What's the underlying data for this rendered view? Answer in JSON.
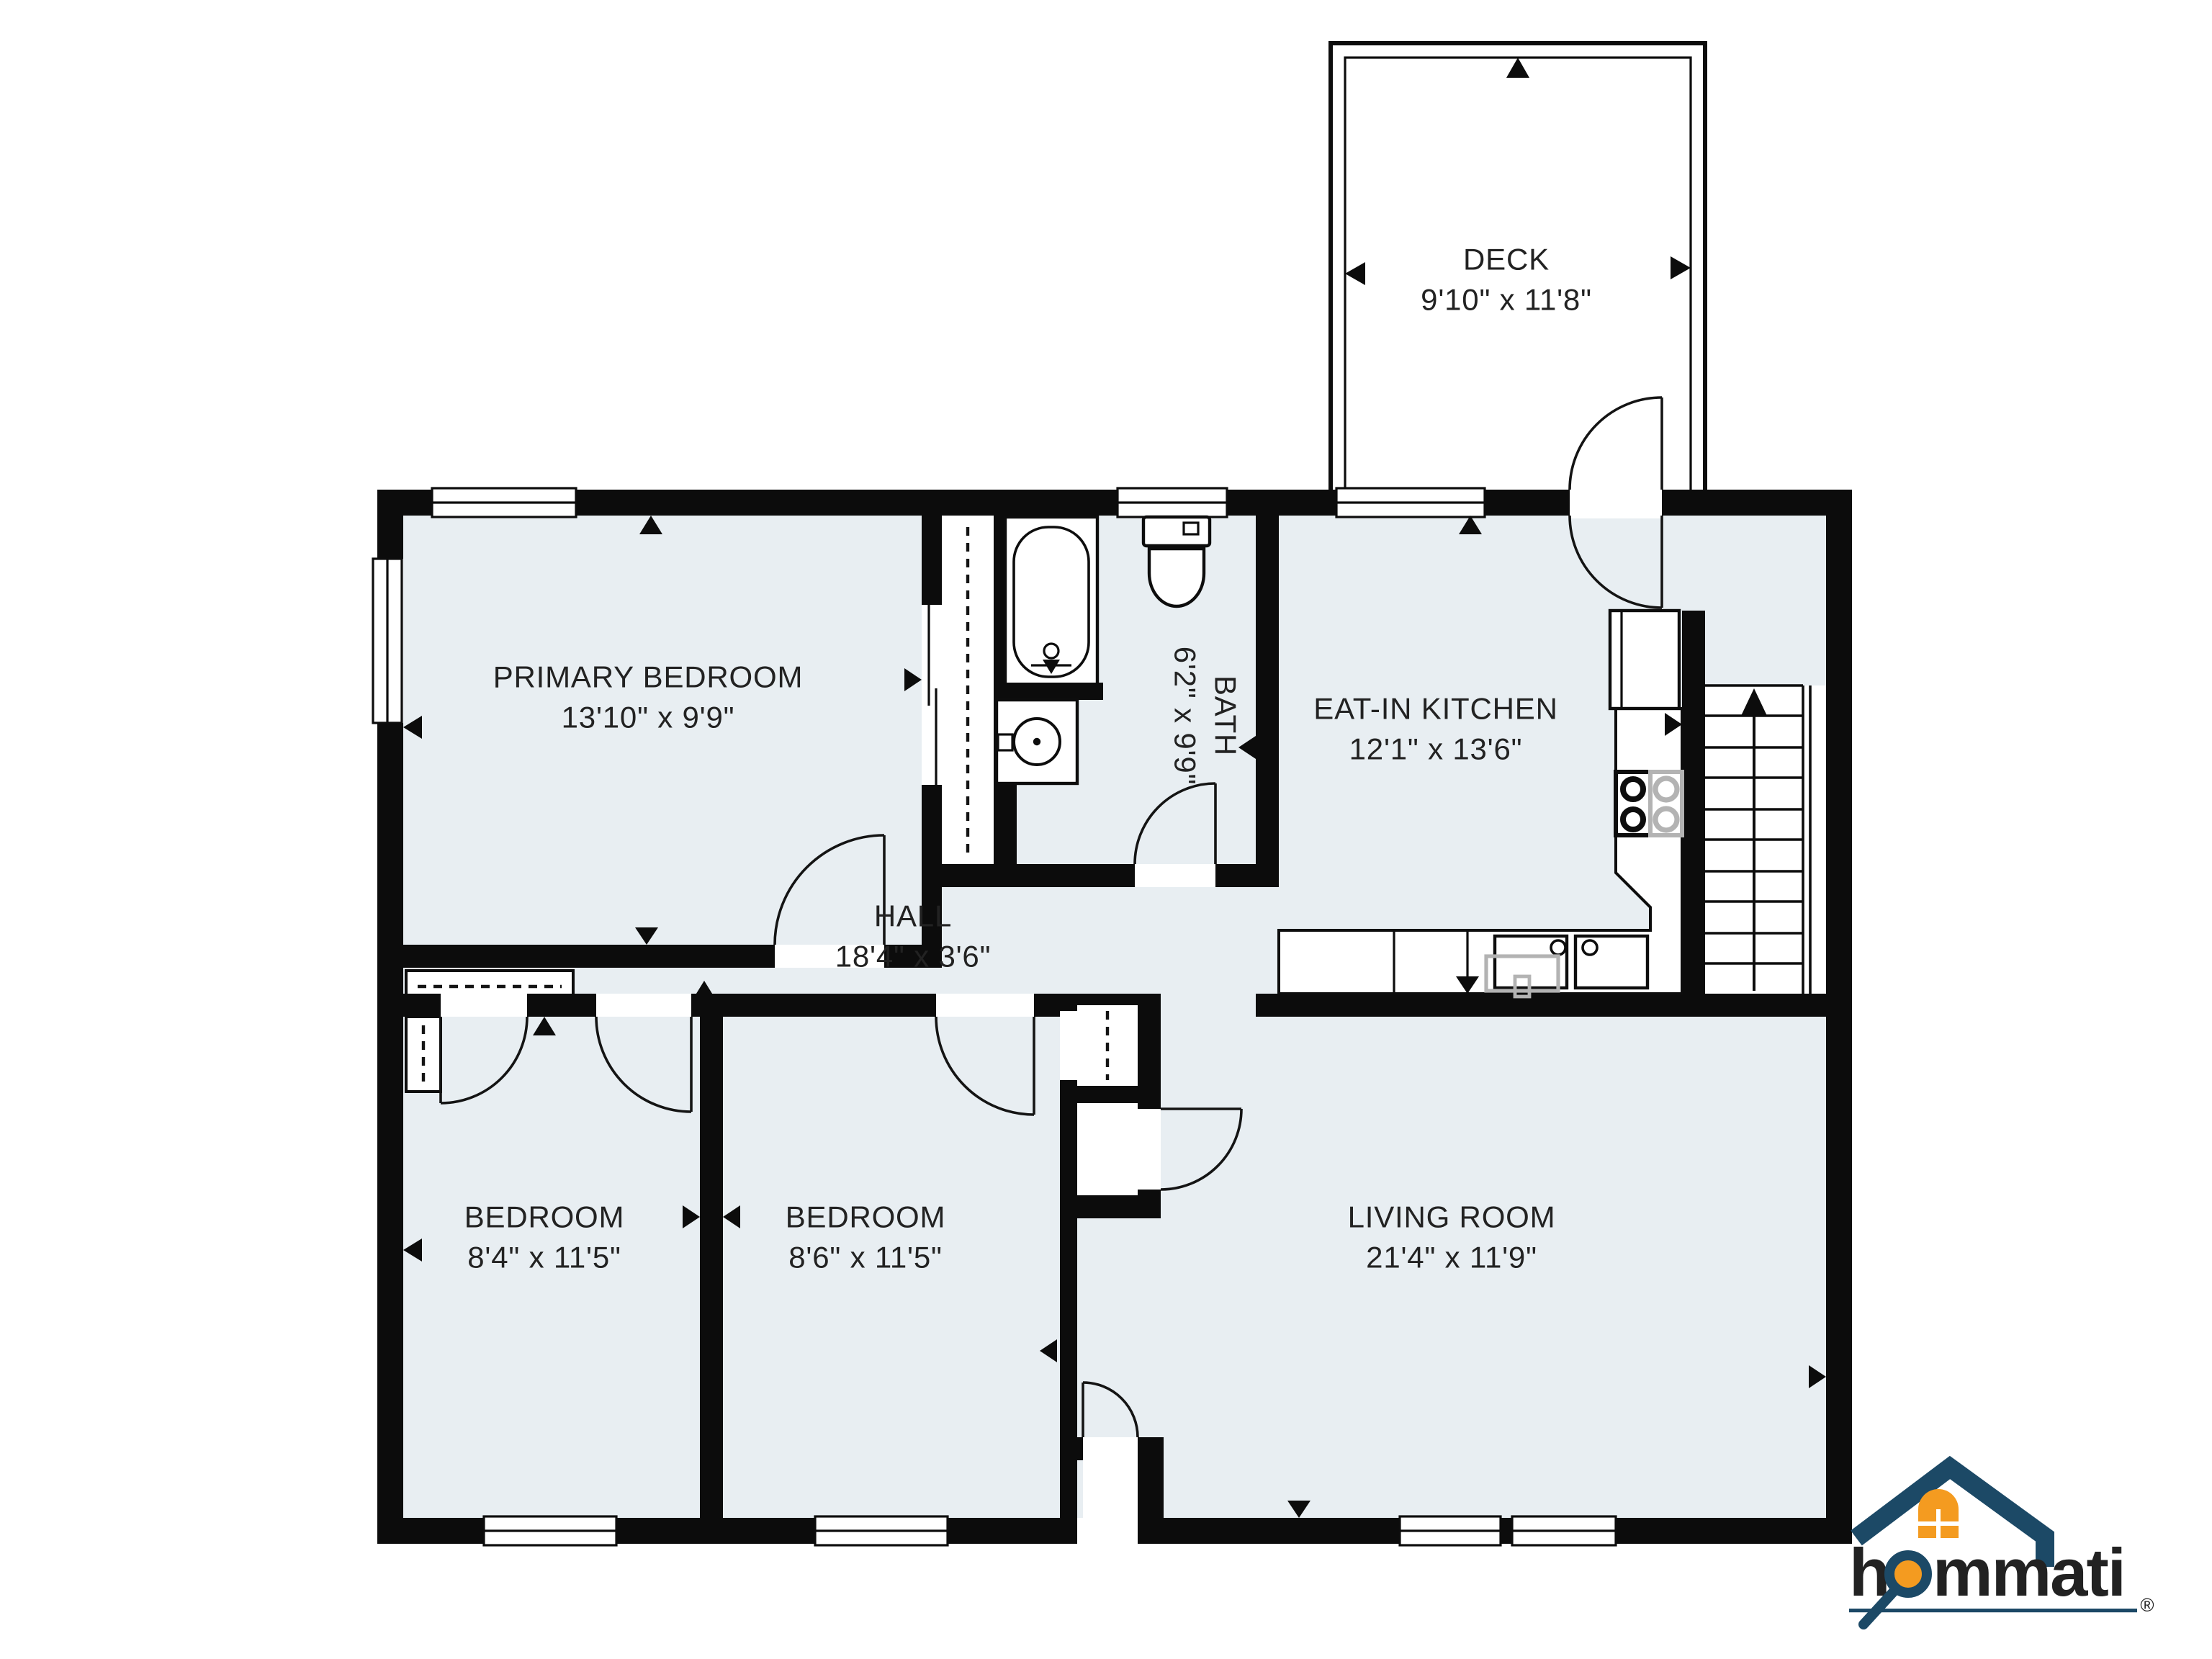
{
  "colors": {
    "floor": "#e8eef2",
    "wall": "#0c0c0c",
    "brand_navy": "#1c4966",
    "brand_orange": "#f49b20"
  },
  "rooms": [
    {
      "id": "deck",
      "name": "DECK",
      "dims": "9'10\" x 11'8\""
    },
    {
      "id": "primary-bedroom",
      "name": "PRIMARY BEDROOM",
      "dims": "13'10\" x 9'9\""
    },
    {
      "id": "bath",
      "name": "BATH",
      "dims": "6'2\" x 9'9\""
    },
    {
      "id": "eat-in-kitchen",
      "name": "EAT-IN KITCHEN",
      "dims": "12'1\" x 13'6\""
    },
    {
      "id": "hall",
      "name": "HALL",
      "dims": "18'4\" x 3'6\""
    },
    {
      "id": "bedroom-left",
      "name": "BEDROOM",
      "dims": "8'4\" x 11'5\""
    },
    {
      "id": "bedroom-middle",
      "name": "BEDROOM",
      "dims": "8'6\" x 11'5\""
    },
    {
      "id": "living-room",
      "name": "LIVING ROOM",
      "dims": "21'4\" x 11'9\""
    }
  ],
  "logo": {
    "brand": "hommati",
    "registered": "®"
  }
}
